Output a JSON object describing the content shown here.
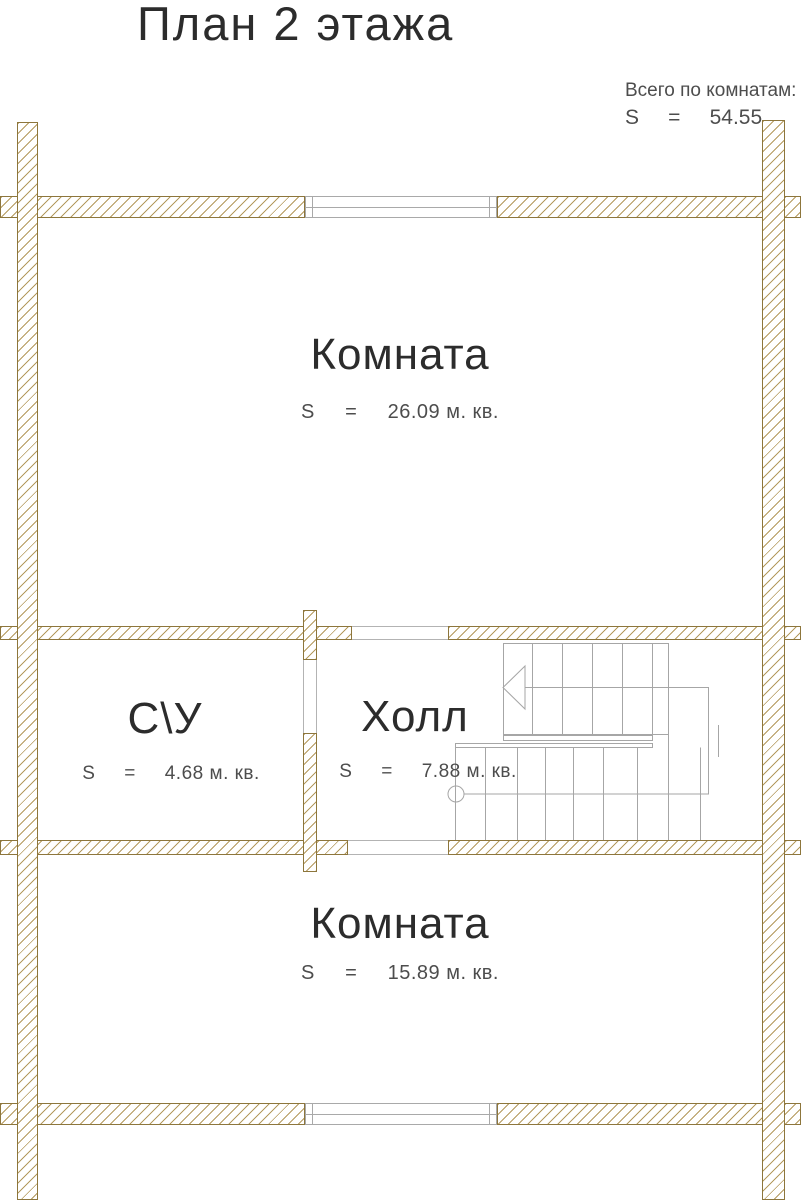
{
  "title": "План 2 этажа",
  "summary": {
    "label": "Всего по комнатам:",
    "s_line": "S     =     54.55"
  },
  "rooms": [
    {
      "name": "Комната",
      "area_line": "S     =     26.09 м. кв."
    },
    {
      "name": "С\\У",
      "area_line": "S     =     4.68 м. кв."
    },
    {
      "name": "Холл",
      "area_line": "S     =     7.88 м. кв."
    },
    {
      "name": "Комната",
      "area_line": "S     =     15.89 м. кв."
    }
  ],
  "colors": {
    "wall_hatch": "#b49a5e",
    "wall_border": "#8d763c",
    "drawing_lines": "#a6a6a6",
    "text_dark": "#2c2c2c",
    "text_gray": "#4d4d4d"
  }
}
